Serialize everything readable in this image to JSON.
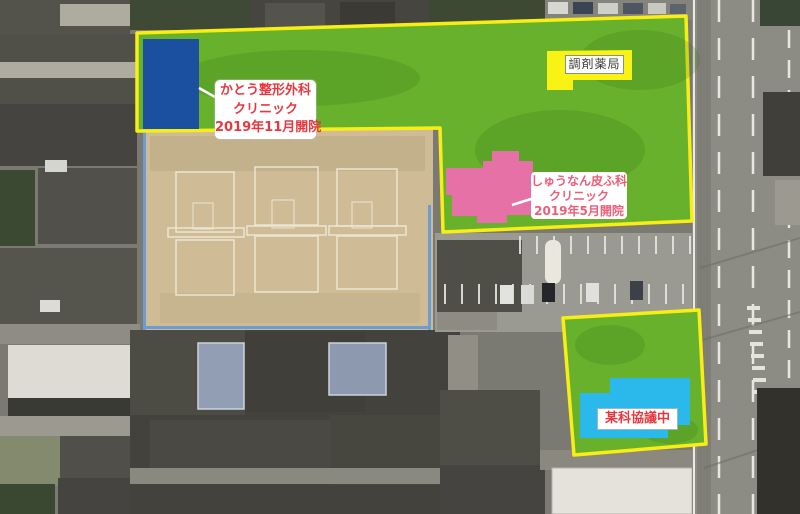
{
  "annotations": {
    "kato_clinic": {
      "lines": [
        "かとう整形外科",
        "クリニック",
        "2019年11月開院"
      ]
    },
    "pharmacy": {
      "text": "調剤薬局"
    },
    "dermatology_clinic": {
      "lines": [
        "しゅうなん皮ふ科",
        "クリニック",
        "2019年5月開院"
      ]
    },
    "negotiation": {
      "text": "某科協議中"
    }
  },
  "colors": {
    "site_overlay_green": "#67b12c",
    "boundary_yellow": "#f8ee15",
    "kato_building_blue": "#1b4f9f",
    "pharmacy_yellow": "#f9f215",
    "dermatology_pink": "#e571a7",
    "negotiation_cyan": "#2bb8ea",
    "label_text_red": "#e8383f",
    "label_text_pink": "#ec5e79",
    "pharmacy_text_dark": "#3c3c3c",
    "label_background": "#ffffff"
  }
}
